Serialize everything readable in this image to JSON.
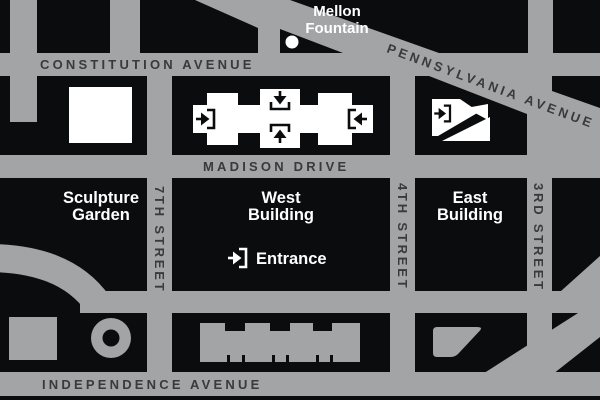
{
  "title": "National Gallery of Art area map",
  "colors": {
    "street": "#a3a4a6",
    "block": "#0b0c0d",
    "building": "#ffffff",
    "streetLabel": "#3a393c"
  },
  "streets": {
    "constitution": "CONSTITUTION AVENUE",
    "pennsylvania": "PENNSYLVANIA AVENUE",
    "madison": "MADISON DRIVE",
    "independence": "INDEPENDENCE AVENUE",
    "seventh": "7TH STREET",
    "fourth": "4TH STREET",
    "third": "3RD STREET"
  },
  "places": {
    "mellon_line1": "Mellon",
    "mellon_line2": "Fountain",
    "sculpture_line1": "Sculpture",
    "sculpture_line2": "Garden",
    "west_line1": "West",
    "west_line2": "Building",
    "east_line1": "East",
    "east_line2": "Building",
    "entrance": "Entrance"
  },
  "icons": {
    "entrance_glyph": "arrow-into-bracket",
    "mellon_marker": "white-dot"
  }
}
